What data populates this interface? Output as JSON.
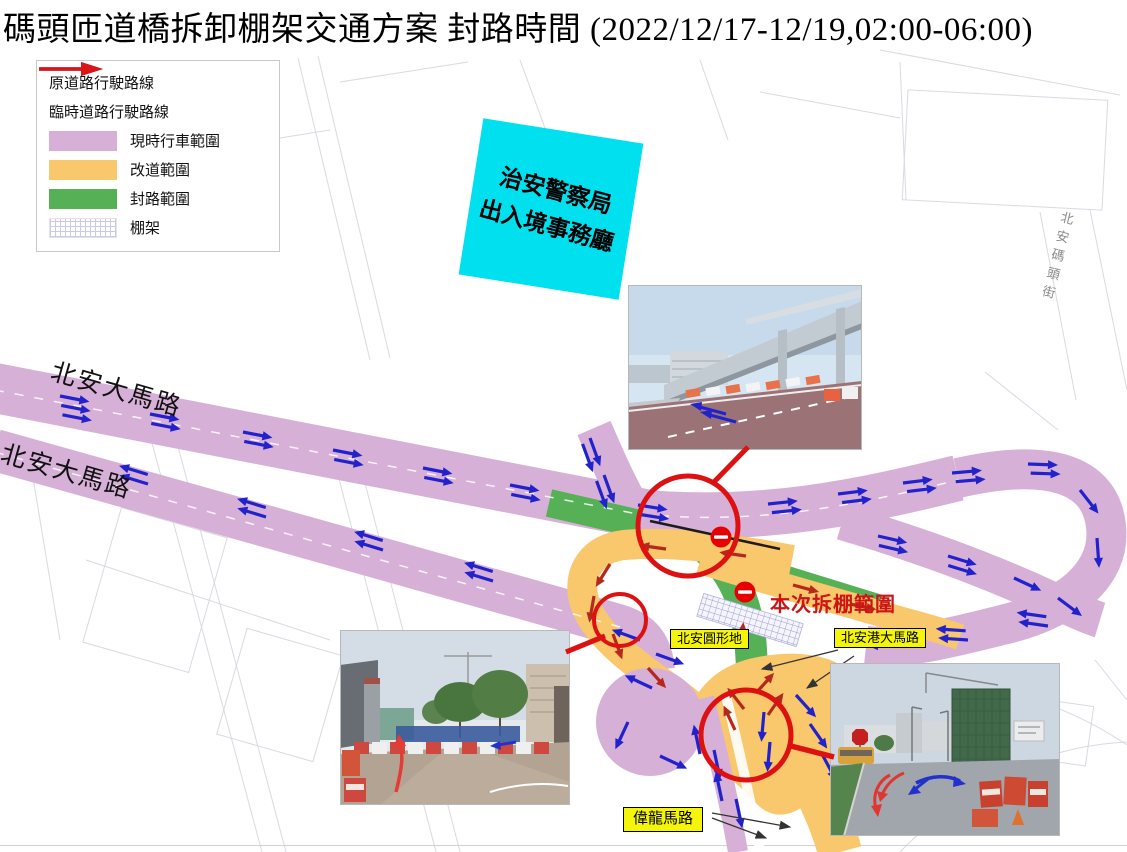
{
  "title": "碼頭匝道橋拆卸棚架交通方案 封路時間 (2022/12/17-12/19,02:00-06:00)",
  "legend": {
    "items": [
      {
        "label": "原道路行駛路線",
        "type": "blue-arrow"
      },
      {
        "label": "臨時道路行駛路線",
        "type": "red-arrow"
      },
      {
        "label": "現時行車範圍",
        "type": "swatch",
        "color": "#d7b0d7"
      },
      {
        "label": "改道範圍",
        "type": "swatch",
        "color": "#f9c76c"
      },
      {
        "label": "封路範圍",
        "type": "swatch",
        "color": "#56b056"
      },
      {
        "label": "棚架",
        "type": "hatch"
      }
    ]
  },
  "map": {
    "building_label": {
      "line1": "治安警察局",
      "line2": "出入境事務廳"
    },
    "road_label_upper": "北安大馬路",
    "road_label_lower": "北安大馬路",
    "street_label_right": "北安碼頭街",
    "annotation_demolition": "本次拆棚範圍",
    "label_roundabout": "北安圓形地",
    "label_pac_on_port": "北安港大馬路",
    "label_wai_long": "偉龍馬路"
  },
  "colors": {
    "current_traffic": "#d7b0d7",
    "diversion": "#f9c76c",
    "closure": "#56b056",
    "original_route_arrow": "#2222cc",
    "temporary_route_arrow": "#b5291d",
    "highlight_red": "#dd1111",
    "building_cyan": "#00e0ee",
    "label_yellow": "#f5f50a"
  }
}
